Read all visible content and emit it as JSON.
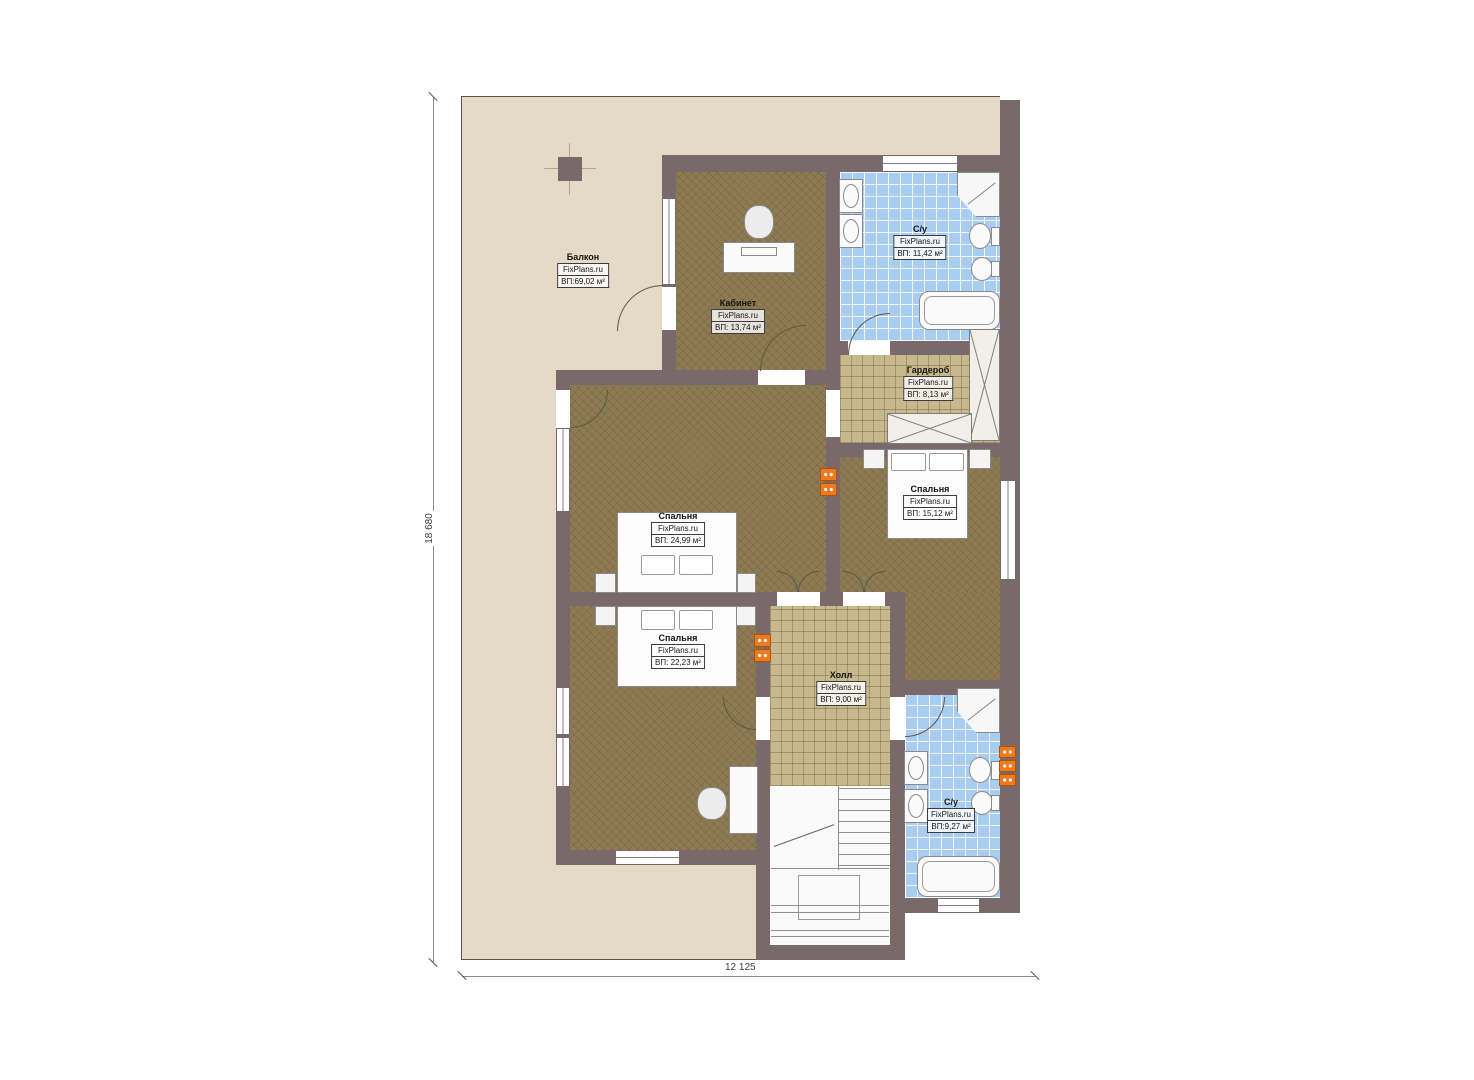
{
  "plan": {
    "rooms": [
      {
        "id": "balcony",
        "name": "Балкон",
        "brand": "FixPlans.ru",
        "area": "ВП:69,02 м²"
      },
      {
        "id": "study",
        "name": "Кабинет",
        "brand": "FixPlans.ru",
        "area": "ВП: 13,74 м²"
      },
      {
        "id": "bathroom-top",
        "name": "С/у",
        "brand": "FixPlans.ru",
        "area": "ВП: 11,42 м²"
      },
      {
        "id": "wardrobe",
        "name": "Гардероб",
        "brand": "FixPlans.ru",
        "area": "ВП: 8,13 м²"
      },
      {
        "id": "bedroom-right",
        "name": "Спальня",
        "brand": "FixPlans.ru",
        "area": "ВП: 15,12 м²"
      },
      {
        "id": "bedroom-master",
        "name": "Спальня",
        "brand": "FixPlans.ru",
        "area": "ВП: 24,99 м²"
      },
      {
        "id": "bedroom-bottom",
        "name": "Спальня",
        "brand": "FixPlans.ru",
        "area": "ВП: 22,23 м²"
      },
      {
        "id": "hall",
        "name": "Холл",
        "brand": "FixPlans.ru",
        "area": "ВП: 9,00 м²"
      },
      {
        "id": "bathroom-bottom",
        "name": "С/у",
        "brand": "FixPlans.ru",
        "area": "ВП:9,27 м²"
      }
    ],
    "dimensions": {
      "height": "18 680",
      "width": "12 125"
    }
  },
  "colors": {
    "wall": "#7a696b",
    "balcony": "#e4dac5",
    "wood": "#8e7b54",
    "tan": "#c8b88e",
    "tile": "#a9cdf1",
    "outlet": "#ee7a20"
  }
}
